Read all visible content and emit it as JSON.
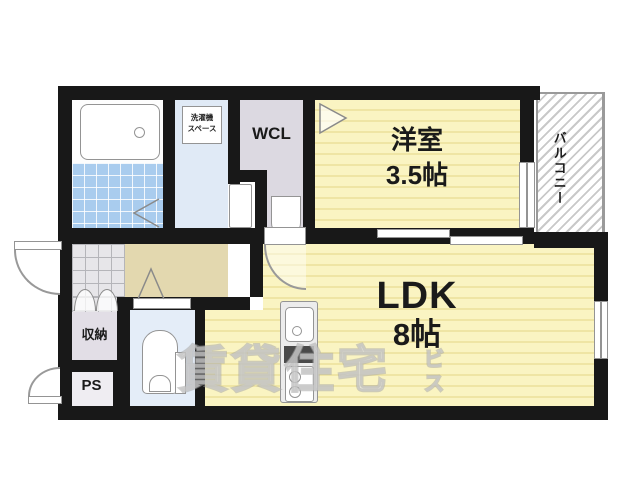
{
  "rooms": {
    "western": {
      "name": "洋室",
      "size": "3.5帖"
    },
    "ldk": {
      "name": "LDK",
      "size": "8帖"
    },
    "wcl": {
      "name": "WCL"
    },
    "balcony": {
      "name": "バルコニー"
    },
    "storage": {
      "name": "収納"
    },
    "pipe_space": {
      "name": "PS"
    },
    "laundry": {
      "line1": "洗濯機",
      "line2": "スペース"
    }
  },
  "watermark": {
    "main": "賃貸住宅",
    "tail_top": "ビ",
    "tail_bottom": "ス"
  },
  "colors": {
    "wall": "#181818",
    "room_yellow": "#faf4c2",
    "room_yellow_stripe": "#efe5a4",
    "hall_beige": "#e3d8af",
    "closet_gray": "#dcd9e1",
    "wet_area_blue": "#e0eaf6",
    "bath_tile_blue": "#a9ccee",
    "symbol_gray": "#999999"
  }
}
